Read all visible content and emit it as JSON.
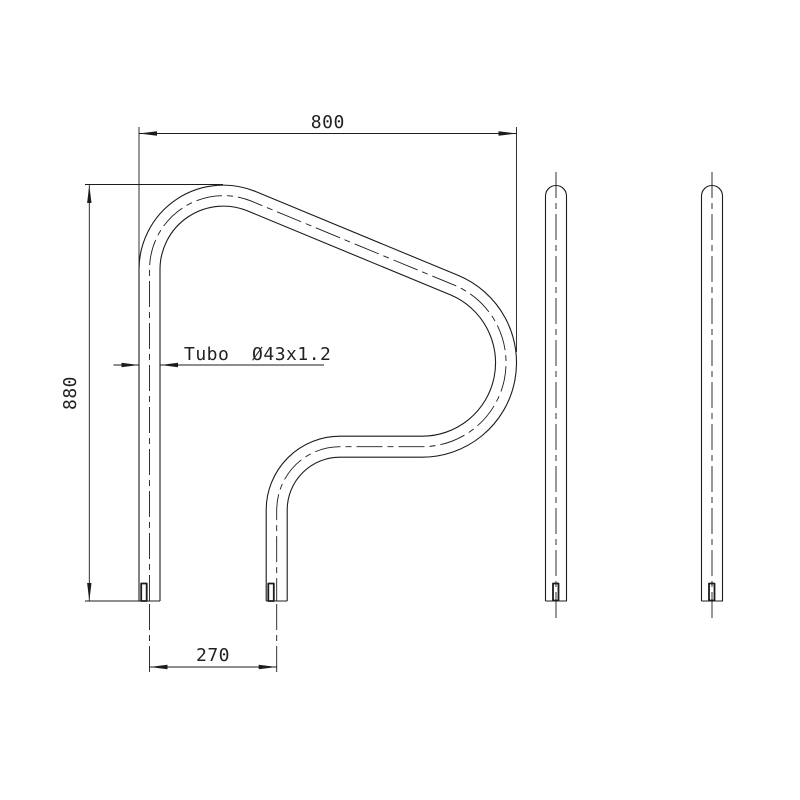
{
  "page": {
    "background_color": "#ffffff",
    "line_color": "#1c1c1c",
    "text_color": "#222222"
  },
  "labels": {
    "top_width": "800",
    "left_height": "880",
    "bottom_spacing": "270",
    "tube_spec": "Tubo  Ø43x1.2"
  },
  "drawing": {
    "type": "technical-orthographic",
    "subject": "pool-handrail",
    "views": {
      "front_view": "P-shaped grab rail with two legs",
      "side_views": "two straight tube profiles with round caps"
    },
    "dimensions_mm": {
      "overall_width": 800,
      "overall_height": 880,
      "leg_center_spacing": 270,
      "tube_diameter_wall": "Ø43x1.2"
    }
  }
}
